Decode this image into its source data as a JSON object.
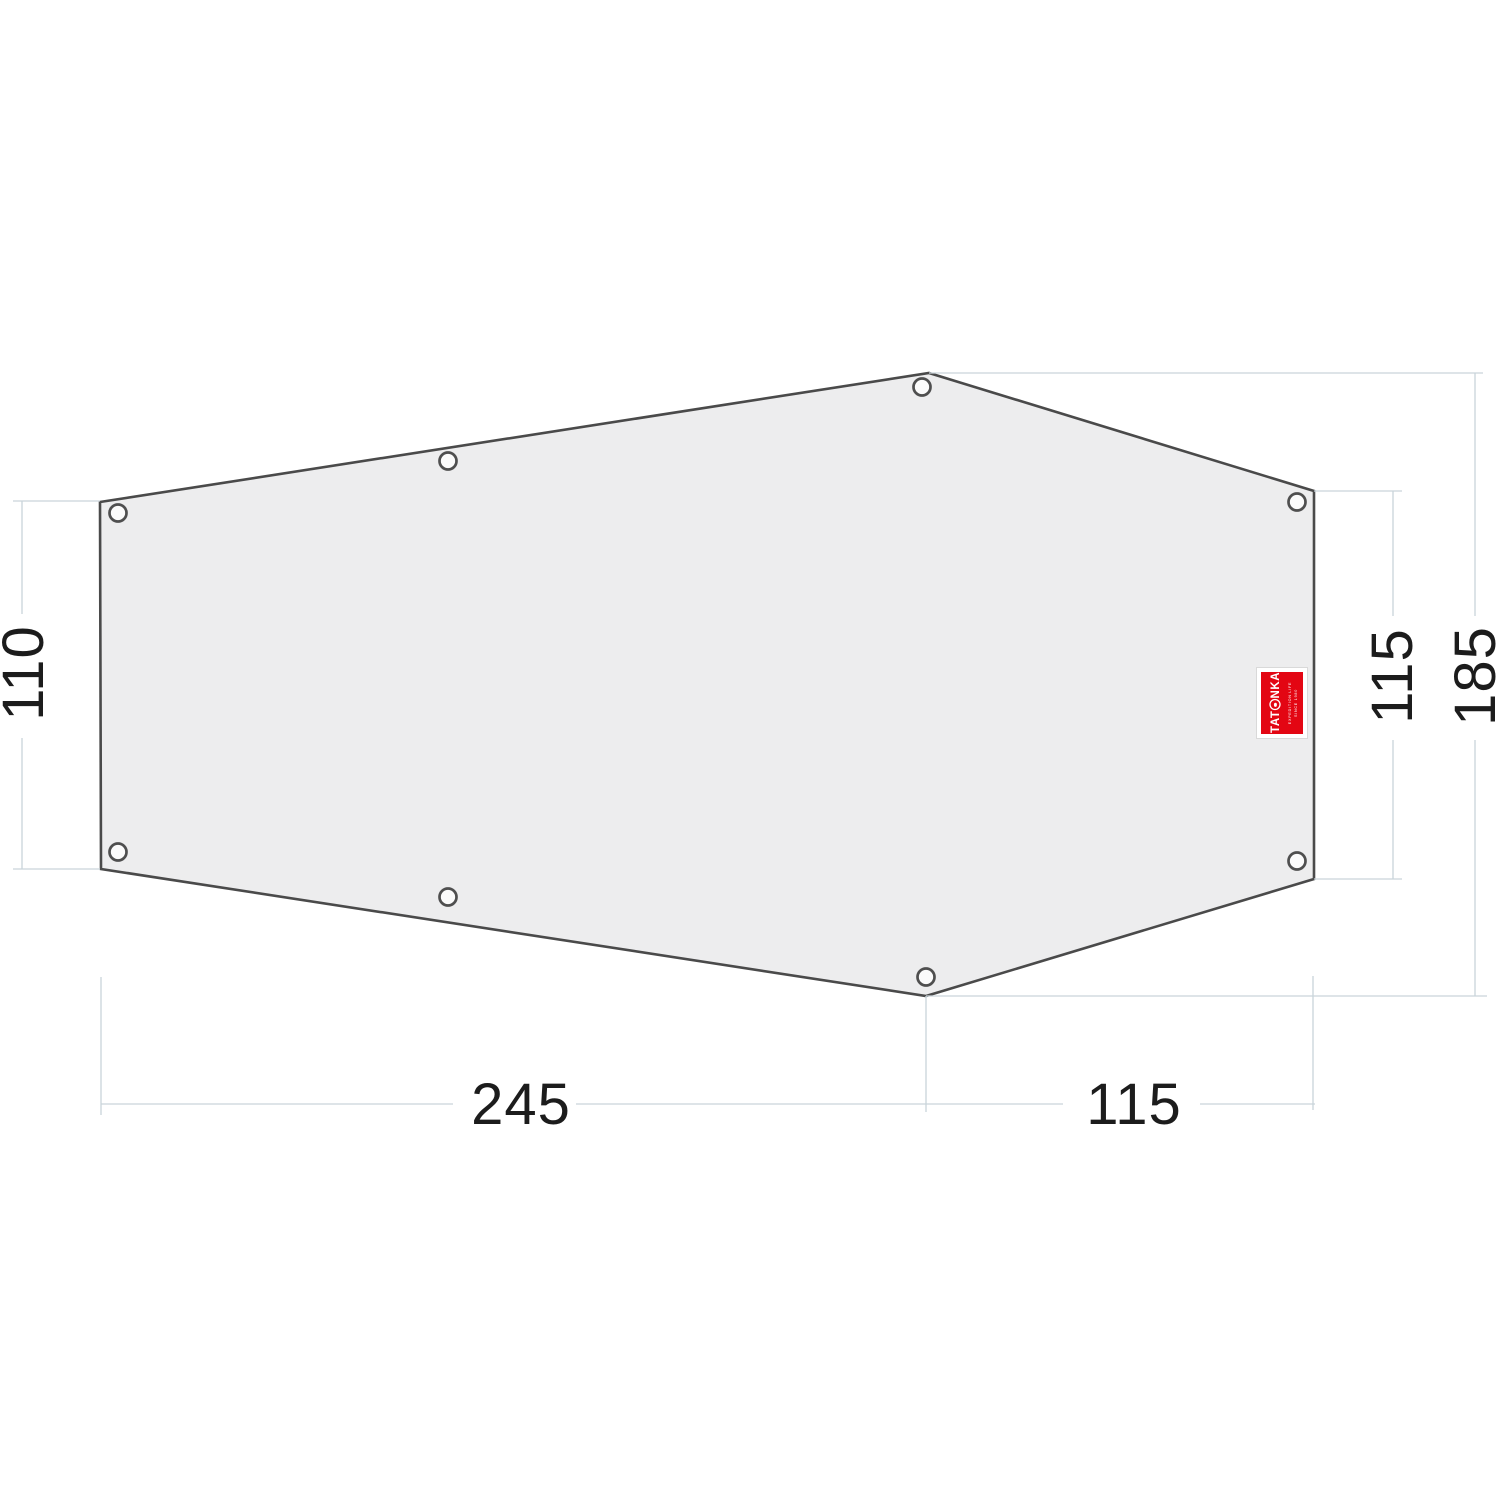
{
  "diagram": {
    "kind": "tent-footprint-dimension-drawing",
    "dimension_labels": {
      "left_height": "110",
      "right_inner_height": "115",
      "right_outer_height": "185",
      "bottom_left_width": "245",
      "bottom_right_width": "115"
    },
    "logo": {
      "brand": "TATONKA",
      "brand_prefix": "TAT",
      "brand_suffix": "NKA",
      "tagline": "EXPEDITION LIFE",
      "tagline2": "SINCE 1980",
      "background": "#e30613"
    },
    "colors": {
      "sheet_fill": "#ededee",
      "sheet_stroke": "#4a4a4a",
      "guide_line": "#c9d4da",
      "label_text": "#1c1c1c"
    }
  }
}
